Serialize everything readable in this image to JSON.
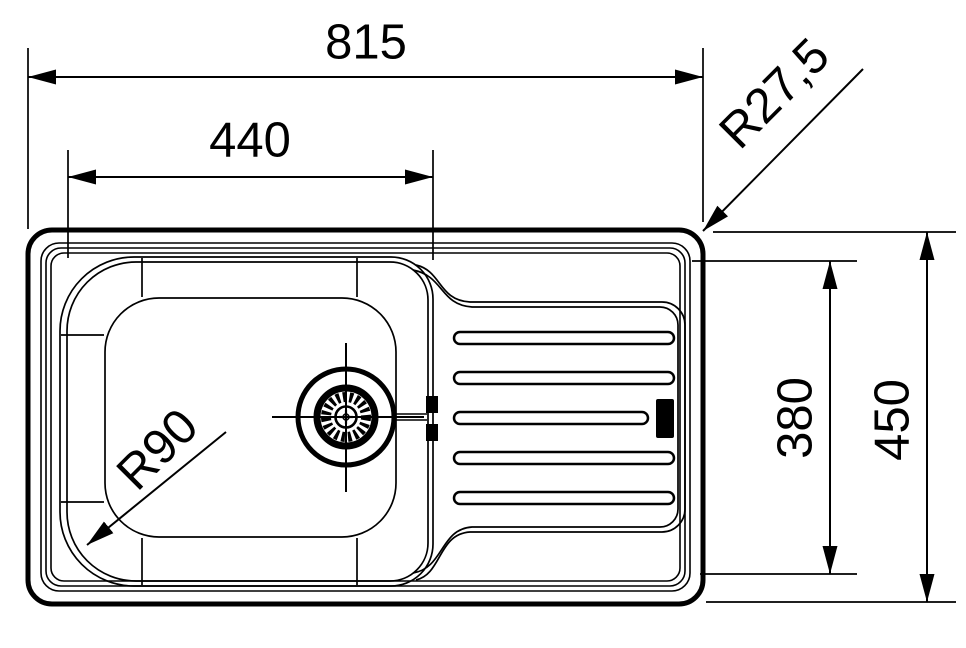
{
  "drawing": {
    "background_color": "#ffffff",
    "line_color": "#000000",
    "dimensions": {
      "overall_width": "815",
      "bowl_width": "440",
      "overall_depth": "450",
      "inner_depth": "380",
      "outer_corner_radius": "R27,5",
      "bowl_corner_radius": "R90"
    }
  }
}
